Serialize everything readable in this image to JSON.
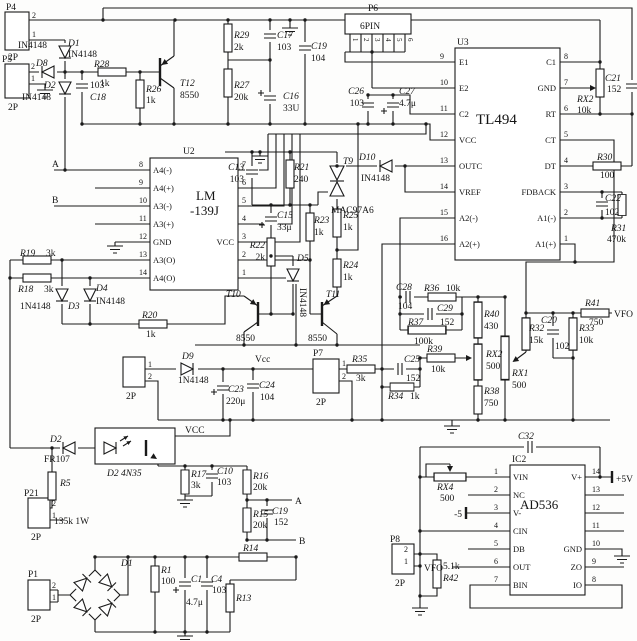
{
  "connectors": {
    "P4": {
      "ref": "P4",
      "type": "2P",
      "pin1": "1",
      "pin2": "2"
    },
    "P5": {
      "ref": "P5",
      "type": "2P",
      "pin1": "1",
      "pin2": "2"
    },
    "P6": {
      "ref": "P6",
      "type": "6PIN",
      "pins": [
        "1",
        "2",
        "3",
        "4",
        "5",
        "6"
      ]
    },
    "P7": {
      "ref": "P7",
      "type": "2P",
      "pin1": "1",
      "pin2": "2"
    },
    "P8": {
      "ref": "P8",
      "type": "2P",
      "pin1": "1",
      "pin2": "2"
    },
    "P21": {
      "ref": "P21",
      "type": "2P",
      "pin1": "1",
      "pin2": "2"
    },
    "P1": {
      "ref": "P1",
      "type": "2P",
      "pin1": "1",
      "pin2": "2"
    },
    "J1": {
      "ref": "",
      "type": "2P",
      "pin1": "1",
      "pin2": "2"
    }
  },
  "ics": {
    "U3": {
      "ref": "U3",
      "part": "TL494",
      "left": [
        {
          "n": "9",
          "l": "E1"
        },
        {
          "n": "10",
          "l": "E2"
        },
        {
          "n": "11",
          "l": "C2"
        },
        {
          "n": "12",
          "l": "VCC"
        },
        {
          "n": "13",
          "l": "OUTC"
        },
        {
          "n": "14",
          "l": "VREF"
        },
        {
          "n": "15",
          "l": "A2(-)"
        },
        {
          "n": "16",
          "l": "A2(+)"
        }
      ],
      "right": [
        {
          "n": "8",
          "l": "C1"
        },
        {
          "n": "7",
          "l": "GND"
        },
        {
          "n": "6",
          "l": "RT"
        },
        {
          "n": "5",
          "l": "CT"
        },
        {
          "n": "4",
          "l": "DT"
        },
        {
          "n": "3",
          "l": "FDBACK"
        },
        {
          "n": "2",
          "l": "A1(-)"
        },
        {
          "n": "1",
          "l": "A1(+)"
        }
      ]
    },
    "U2": {
      "ref": "U2",
      "part1": "LM",
      "part2": "-139J",
      "left": [
        {
          "n": "8",
          "l": "A4(-)"
        },
        {
          "n": "9",
          "l": "A4(+)"
        },
        {
          "n": "10",
          "l": "A3(-)"
        },
        {
          "n": "11",
          "l": "A3(+)"
        },
        {
          "n": "12",
          "l": "GND"
        },
        {
          "n": "13",
          "l": "A3(O)"
        },
        {
          "n": "14",
          "l": "A4(O)"
        }
      ],
      "right": [
        {
          "n": "7",
          "l": ""
        },
        {
          "n": "6",
          "l": ""
        },
        {
          "n": "5",
          "l": ""
        },
        {
          "n": "4",
          "l": ""
        },
        {
          "n": "3",
          "l": "VCC"
        },
        {
          "n": "2",
          "l": ""
        },
        {
          "n": "1",
          "l": ""
        }
      ]
    },
    "IC2": {
      "ref": "IC2",
      "part": "AD536",
      "left": [
        {
          "n": "1",
          "l": "VIN"
        },
        {
          "n": "2",
          "l": "NC"
        },
        {
          "n": "3",
          "l": "V-"
        },
        {
          "n": "4",
          "l": "CIN"
        },
        {
          "n": "5",
          "l": "DB"
        },
        {
          "n": "6",
          "l": "OUT"
        },
        {
          "n": "7",
          "l": "BIN"
        }
      ],
      "right": [
        {
          "n": "14",
          "l": "V+"
        },
        {
          "n": "13",
          "l": ""
        },
        {
          "n": "12",
          "l": ""
        },
        {
          "n": "11",
          "l": ""
        },
        {
          "n": "10",
          "l": "GND"
        },
        {
          "n": "9",
          "l": "ZO"
        },
        {
          "n": "8",
          "l": "IO"
        }
      ]
    }
  },
  "parts": {
    "D1a": {
      "r": "D1",
      "v": "IN4148",
      "v2": "IN4148"
    },
    "D8": {
      "r": "D8"
    },
    "D2a": {
      "r": "D2",
      "v": "IN4148"
    },
    "R28": {
      "r": "R28",
      "v": "1k"
    },
    "C18": {
      "r": "C18",
      "v": "103"
    },
    "R26": {
      "r": "R26",
      "v": "1k"
    },
    "T12": {
      "r": "T12",
      "v": "8550"
    },
    "R29": {
      "r": "R29",
      "v": "2k"
    },
    "C17": {
      "r": "C17",
      "v": "103"
    },
    "R27": {
      "r": "R27",
      "v": "20k"
    },
    "C16": {
      "r": "C16",
      "v": "33U"
    },
    "C19a": {
      "r": "C19",
      "v": "104"
    },
    "C26": {
      "r": "C26",
      "v": "103"
    },
    "C27": {
      "r": "C27",
      "v": "4.7μ"
    },
    "RX2a": {
      "r": "RX2",
      "v": "10k"
    },
    "C21": {
      "r": "C21",
      "v": "152"
    },
    "R30": {
      "r": "R30",
      "v": "100"
    },
    "C22": {
      "r": "C22",
      "v": "102"
    },
    "R31": {
      "r": "R31",
      "v": "470k"
    },
    "D10": {
      "r": "D10",
      "v": "IN4148"
    },
    "C13": {
      "r": "C13",
      "v": "103"
    },
    "R21": {
      "r": "R21",
      "v": "240"
    },
    "T9": {
      "r": "T9",
      "v": "MAC97A6"
    },
    "C15": {
      "r": "C15",
      "v": "33μ"
    },
    "R23": {
      "r": "R23",
      "v": "1k"
    },
    "R25": {
      "r": "R25",
      "v": "1k"
    },
    "R22": {
      "r": "R22",
      "v": "2k"
    },
    "D5": {
      "r": "D5",
      "v": "IN4148"
    },
    "R24": {
      "r": "R24",
      "v": "1k"
    },
    "T10": {
      "r": "T10",
      "v": "8550"
    },
    "T11": {
      "r": "T11",
      "v": "8550"
    },
    "R19": {
      "r": "R19",
      "v": "3k"
    },
    "R18": {
      "r": "R18",
      "v": "3k"
    },
    "D3": {
      "r": "D3",
      "v": "1N4148"
    },
    "D4": {
      "r": "D4",
      "v": "IN4148"
    },
    "R20": {
      "r": "R20",
      "v": "1k"
    },
    "C28": {
      "r": "C28",
      "v": "104"
    },
    "R36": {
      "r": "R36",
      "v": "10k"
    },
    "C29": {
      "r": "C29",
      "v": "152"
    },
    "R37": {
      "r": "R37",
      "v": "100k"
    },
    "R40": {
      "r": "R40",
      "v": "430"
    },
    "R39": {
      "r": "R39",
      "v": "10k"
    },
    "RX2b": {
      "r": "RX2",
      "v": "500"
    },
    "RX1": {
      "r": "RX1",
      "v": "500"
    },
    "R38": {
      "r": "R38",
      "v": "750"
    },
    "R32": {
      "r": "R32",
      "v": "15k"
    },
    "C20": {
      "r": "C20",
      "v": "102"
    },
    "R33": {
      "r": "R33",
      "v": "10k"
    },
    "R41": {
      "r": "R41",
      "v": "750"
    },
    "D9": {
      "r": "D9",
      "v": "1N4148"
    },
    "C23": {
      "r": "C23",
      "v": "220μ"
    },
    "C24": {
      "r": "C24",
      "v": "104"
    },
    "R35": {
      "r": "R35",
      "v": "3k"
    },
    "C25": {
      "r": "C25",
      "v": "152"
    },
    "R34": {
      "r": "R34",
      "v": "1k"
    },
    "D2b": {
      "r": "D2",
      "v": "FR107"
    },
    "OPT": {
      "r": "D2 4N35"
    },
    "R5": {
      "r": "R5",
      "v": "135k 1W"
    },
    "R17": {
      "r": "R17",
      "v": "3k"
    },
    "C10": {
      "r": "C10",
      "v": "103"
    },
    "R16": {
      "r": "R16",
      "v": "20k"
    },
    "R15": {
      "r": "R15",
      "v": "20k"
    },
    "C19b": {
      "r": "C19",
      "v": "152"
    },
    "R14": {
      "r": "R14"
    },
    "R13": {
      "r": "R13"
    },
    "R1": {
      "r": "R1",
      "v": "100"
    },
    "C1": {
      "r": "C1",
      "v": "4.7μ"
    },
    "C4": {
      "r": "C4",
      "v": "103"
    },
    "D1b": {
      "r": "D1"
    },
    "C32": {
      "r": "C32"
    },
    "RX4": {
      "r": "RX4",
      "v": "500"
    },
    "R42": {
      "r": "R42",
      "v": "5.1k"
    }
  },
  "nets": {
    "A": "A",
    "B": "B",
    "VCC": "VCC",
    "Vcc": "Vcc",
    "VFO": "VFO",
    "p5": "+5V",
    "m5": "-5"
  }
}
